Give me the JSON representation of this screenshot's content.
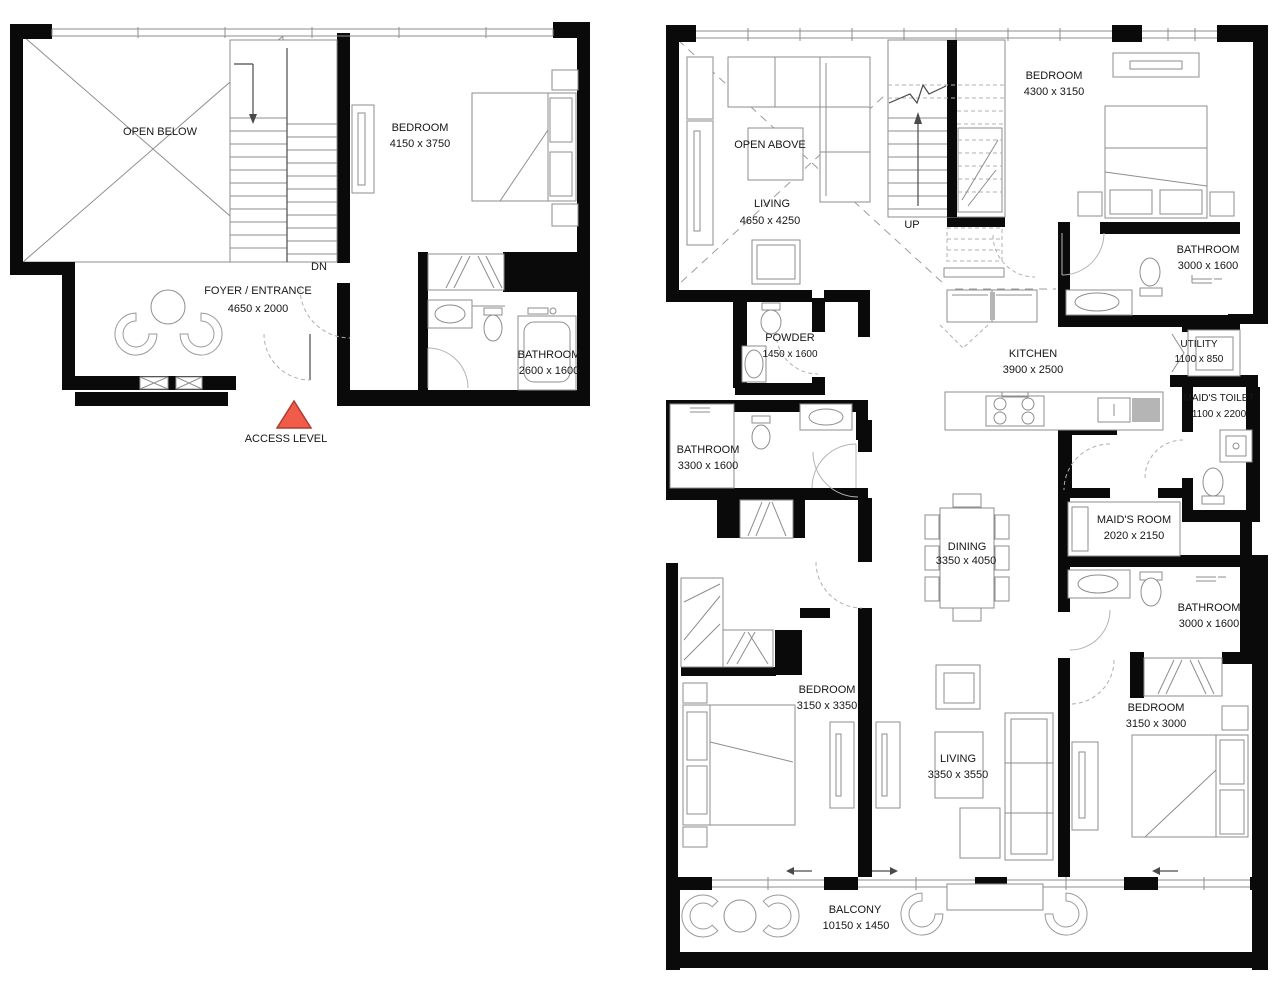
{
  "plan_access": {
    "open_area_label": "OPEN BELOW",
    "stair_label": "DN",
    "marker_label": "ACCESS LEVEL",
    "marker_color": "#f15b4a",
    "rooms": {
      "bedroom": {
        "name": "BEDROOM",
        "dims": "4150 x 3750"
      },
      "foyer": {
        "name": "FOYER / ENTRANCE",
        "dims": "4650 x 2000"
      },
      "bathroom": {
        "name": "BATHROOM",
        "dims": "2600 x 1600"
      }
    }
  },
  "plan_upper": {
    "open_area_label": "OPEN ABOVE",
    "stair_label": "UP",
    "rooms": {
      "living_upper": {
        "name": "LIVING",
        "dims": "4650 x 4250"
      },
      "bedroom_top": {
        "name": "BEDROOM",
        "dims": "4300 x 3150"
      },
      "bathroom_top": {
        "name": "BATHROOM",
        "dims": "3000 x 1600"
      },
      "powder": {
        "name": "POWDER",
        "dims": "1450 x 1600"
      },
      "kitchen": {
        "name": "KITCHEN",
        "dims": "3900 x 2500"
      },
      "utility": {
        "name": "UTILITY",
        "dims": "1100 x 850"
      },
      "maids_toilet": {
        "name": "MAID'S TOILET",
        "dims": "1100 x 2200"
      },
      "bathroom_left": {
        "name": "BATHROOM",
        "dims": "3300 x 1600"
      },
      "maids_room": {
        "name": "MAID'S ROOM",
        "dims": "2020 x 2150"
      },
      "dining": {
        "name": "DINING",
        "dims": "3350 x 4050"
      },
      "bathroom_right": {
        "name": "BATHROOM",
        "dims": "3000 x 1600"
      },
      "bedroom_left": {
        "name": "BEDROOM",
        "dims": "3150 x 3350"
      },
      "living_lower": {
        "name": "LIVING",
        "dims": "3350 x 3550"
      },
      "bedroom_right": {
        "name": "BEDROOM",
        "dims": "3150 x 3000"
      },
      "balcony": {
        "name": "BALCONY",
        "dims": "10150 x 1450"
      }
    }
  }
}
